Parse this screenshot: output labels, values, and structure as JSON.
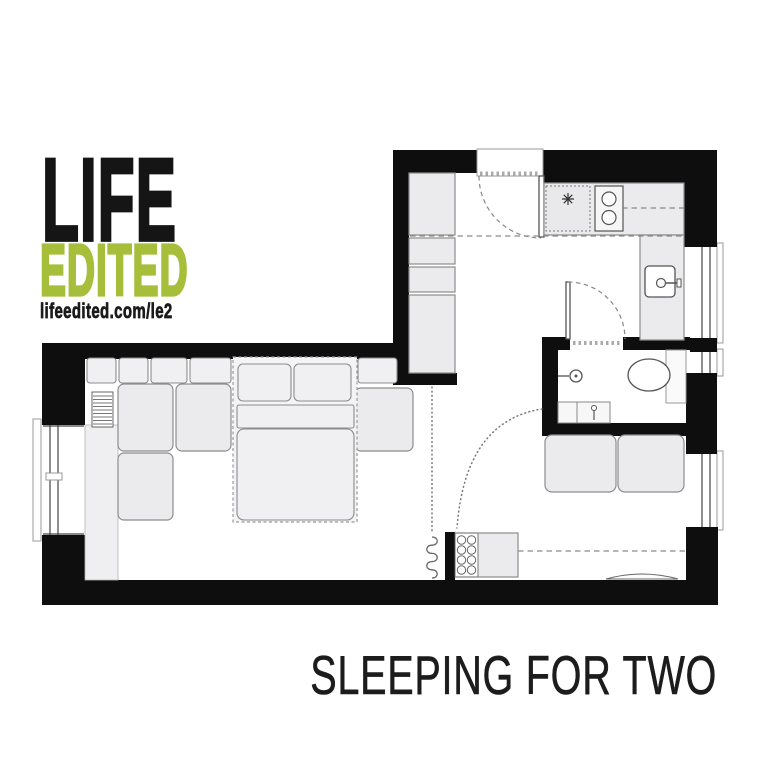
{
  "brand": {
    "title_line1": "LIFE",
    "title_line2": "EDITED",
    "website": "lifeedited.com/le2"
  },
  "caption": {
    "title": "SLEEPING FOR TWO"
  },
  "colors": {
    "accent_green": "#a6be3a",
    "ink_black": "#151515",
    "wall_black": "#0e0e0e",
    "furniture_fill": "#ebebed",
    "furniture_stroke": "#8c8c8c"
  },
  "floor_plan": {
    "type": "studio-apartment-floor-plan",
    "icons": [
      "entry-door",
      "door-swing-arc",
      "wardrobe-closet",
      "refrigerator",
      "stove-burners",
      "kitchen-sink",
      "faucet",
      "overhead-cabinet-dashed-line",
      "window",
      "radiator",
      "bathroom-door",
      "shower-mixer",
      "toilet",
      "washbasin",
      "curtain-track",
      "curtain-coil",
      "sofa-bed-dashed-outline",
      "pillow",
      "mattress",
      "sectional-sofa",
      "bench-sofa",
      "storage-cabinet",
      "fold-down-shelf"
    ]
  }
}
